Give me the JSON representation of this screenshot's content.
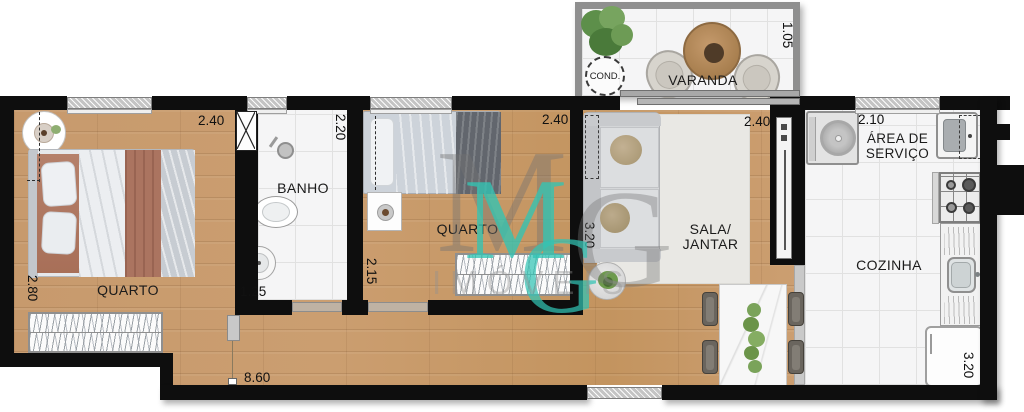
{
  "watermark": {
    "m_gray": "M",
    "g_gray": "G",
    "m_teal": "M",
    "g_teal": "G",
    "word": "IMÓVEIS"
  },
  "rooms": {
    "varanda": {
      "label": "VARANDA",
      "dim": "1.05",
      "cond": "COND."
    },
    "quarto1": {
      "label": "QUARTO",
      "dim_top": "2.40",
      "dim_side": "2.80"
    },
    "banho": {
      "label": "BANHO",
      "dim_top": "2.20",
      "dim_bottom": "1.25"
    },
    "quarto2": {
      "label": "QUARTO",
      "dim_top": "2.40",
      "dim_side": "2.15"
    },
    "sala": {
      "label1": "SALA/",
      "label2": "JANTAR",
      "dim_top": "2.40",
      "dim_side": "3.20"
    },
    "servico": {
      "label1": "ÁREA DE",
      "label2": "SERVIÇO",
      "dim_top": "2.10"
    },
    "cozinha": {
      "label": "COZINHA",
      "dim_side": "3.20"
    },
    "corredor": {
      "dim": "8.60"
    }
  },
  "colors": {
    "wall": "#0e0e0e",
    "wood": "#c8996a",
    "tile": "#f5f5f6",
    "teal": "#32c4b4",
    "varanda_wall": "#8f8f8f"
  }
}
